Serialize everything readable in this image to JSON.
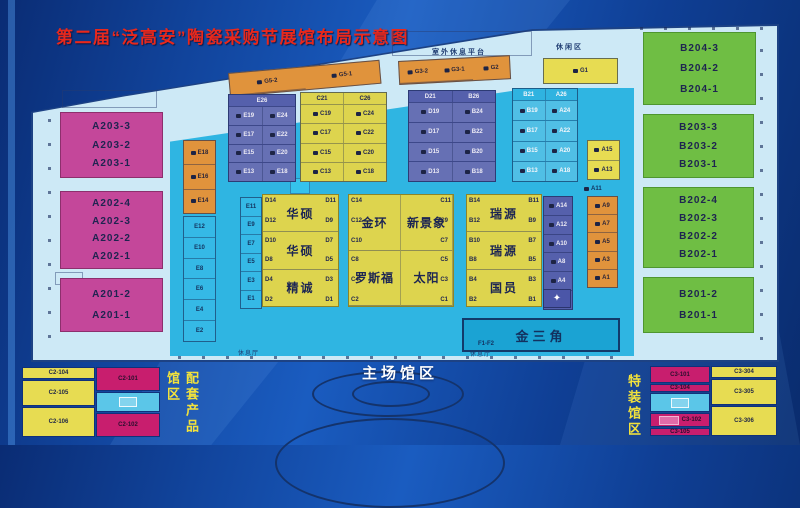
{
  "title": "第二届“泛高安”陶瓷采购节展馆布局示意图",
  "colors": {
    "background": "#11449c",
    "title_red": "#e8281c",
    "magenta": "#c4479a",
    "green": "#6fbe44",
    "yellow": "#ddd44e",
    "orange": "#e0933c",
    "purple": "#5560ac",
    "cyan": "#2fb5e2",
    "plan_base": "#cde9f6",
    "outline_navy": "#123a6a"
  },
  "icons": {
    "booth_table": "dark-rect-css-shape",
    "legend_box": "outlined-box",
    "logo": "✦"
  },
  "labels": {
    "main_hall": "主场馆区",
    "platform": "室外休息平台",
    "leisure": "休闲区",
    "golden_triangle": "金三角",
    "f_zone": "F1-F2",
    "rest_1": "休息厅",
    "rest_2": "休息厅",
    "g1": "G1",
    "a11": "A11"
  },
  "zone_a": {
    "a203": [
      "A203-3",
      "A203-2",
      "A203-1"
    ],
    "a202": [
      "A202-4",
      "A202-3",
      "A202-2",
      "A202-1"
    ],
    "a201": [
      "A201-2",
      "A201-1"
    ]
  },
  "zone_b": {
    "b204": [
      "B204-3",
      "B204-2",
      "B204-1"
    ],
    "b203": [
      "B203-3",
      "B203-2",
      "B203-1"
    ],
    "b202": [
      "B202-4",
      "B202-3",
      "B202-2",
      "B202-1"
    ],
    "b201": [
      "B201-2",
      "B201-1"
    ]
  },
  "top_row": {
    "g5": [
      "G5-2",
      "G5-1"
    ],
    "g3": [
      "G3-2",
      "G3-1",
      "G2"
    ]
  },
  "grids": {
    "e_c": [
      "E26",
      "E19|E24",
      "E17|E22",
      "E15|E20",
      "E13|E18"
    ],
    "c_c": [
      "C21|C26",
      "C19|C24",
      "C17|C22",
      "C15|C20",
      "C13|C18"
    ],
    "d_b": [
      "D21|B26",
      "D19|B24",
      "D17|B22",
      "D15|B20",
      "D13|B18"
    ],
    "b_a": [
      "B21|A26",
      "B19|A24",
      "B17|A22",
      "B15|A20",
      "B13|A18"
    ]
  },
  "columns": {
    "e_orange": [
      "E18",
      "E16",
      "E14"
    ],
    "e_cyan": [
      "E12",
      "E10",
      "E8",
      "E6",
      "E4",
      "E2"
    ],
    "e_odd": [
      "E11",
      "E9",
      "E7",
      "E5",
      "E3",
      "E1"
    ],
    "a_yellow": [
      "A15",
      "A13"
    ],
    "a_purple": [
      "A14",
      "A12",
      "A10",
      "A8",
      "A4",
      "A2"
    ],
    "a_orange": [
      "A9",
      "A7",
      "A5",
      "A3",
      "A1"
    ]
  },
  "companies": {
    "d_names": [
      "华硕",
      "华硕",
      "精诚"
    ],
    "c_names": [
      "金环",
      "新景象",
      "罗斯福",
      "太阳"
    ],
    "b_names": [
      "瑞源",
      "瑞源",
      "国员"
    ],
    "d_left": [
      "D14",
      "D12",
      "D10",
      "D8",
      "D4",
      "D2"
    ],
    "d_right": [
      "D11",
      "D9",
      "D7",
      "D5",
      "D3",
      "D1"
    ],
    "c_left": [
      "C14",
      "C12",
      "C10",
      "C8",
      "C4",
      "C2"
    ],
    "c_right": [
      "C11",
      "C9",
      "C7",
      "C5",
      "C3",
      "C1"
    ],
    "b_left": [
      "B14",
      "B12",
      "B10",
      "B8",
      "B4",
      "B2"
    ],
    "b_right": [
      "B11",
      "B9",
      "B7",
      "B5",
      "B3",
      "B1"
    ]
  },
  "legend_left": {
    "title": "配套产品馆区",
    "yellow_codes": [
      "C2-104",
      "C2-105",
      "C2-106"
    ],
    "magenta_codes": [
      "C2-101",
      "C2-102"
    ]
  },
  "legend_right": {
    "title": "特装馆区",
    "magenta_codes": [
      "C3-101",
      "C3-104",
      "C3-102",
      "C3-105"
    ],
    "yellow_codes": [
      "C3-304",
      "C3-305",
      "C3-306"
    ]
  }
}
